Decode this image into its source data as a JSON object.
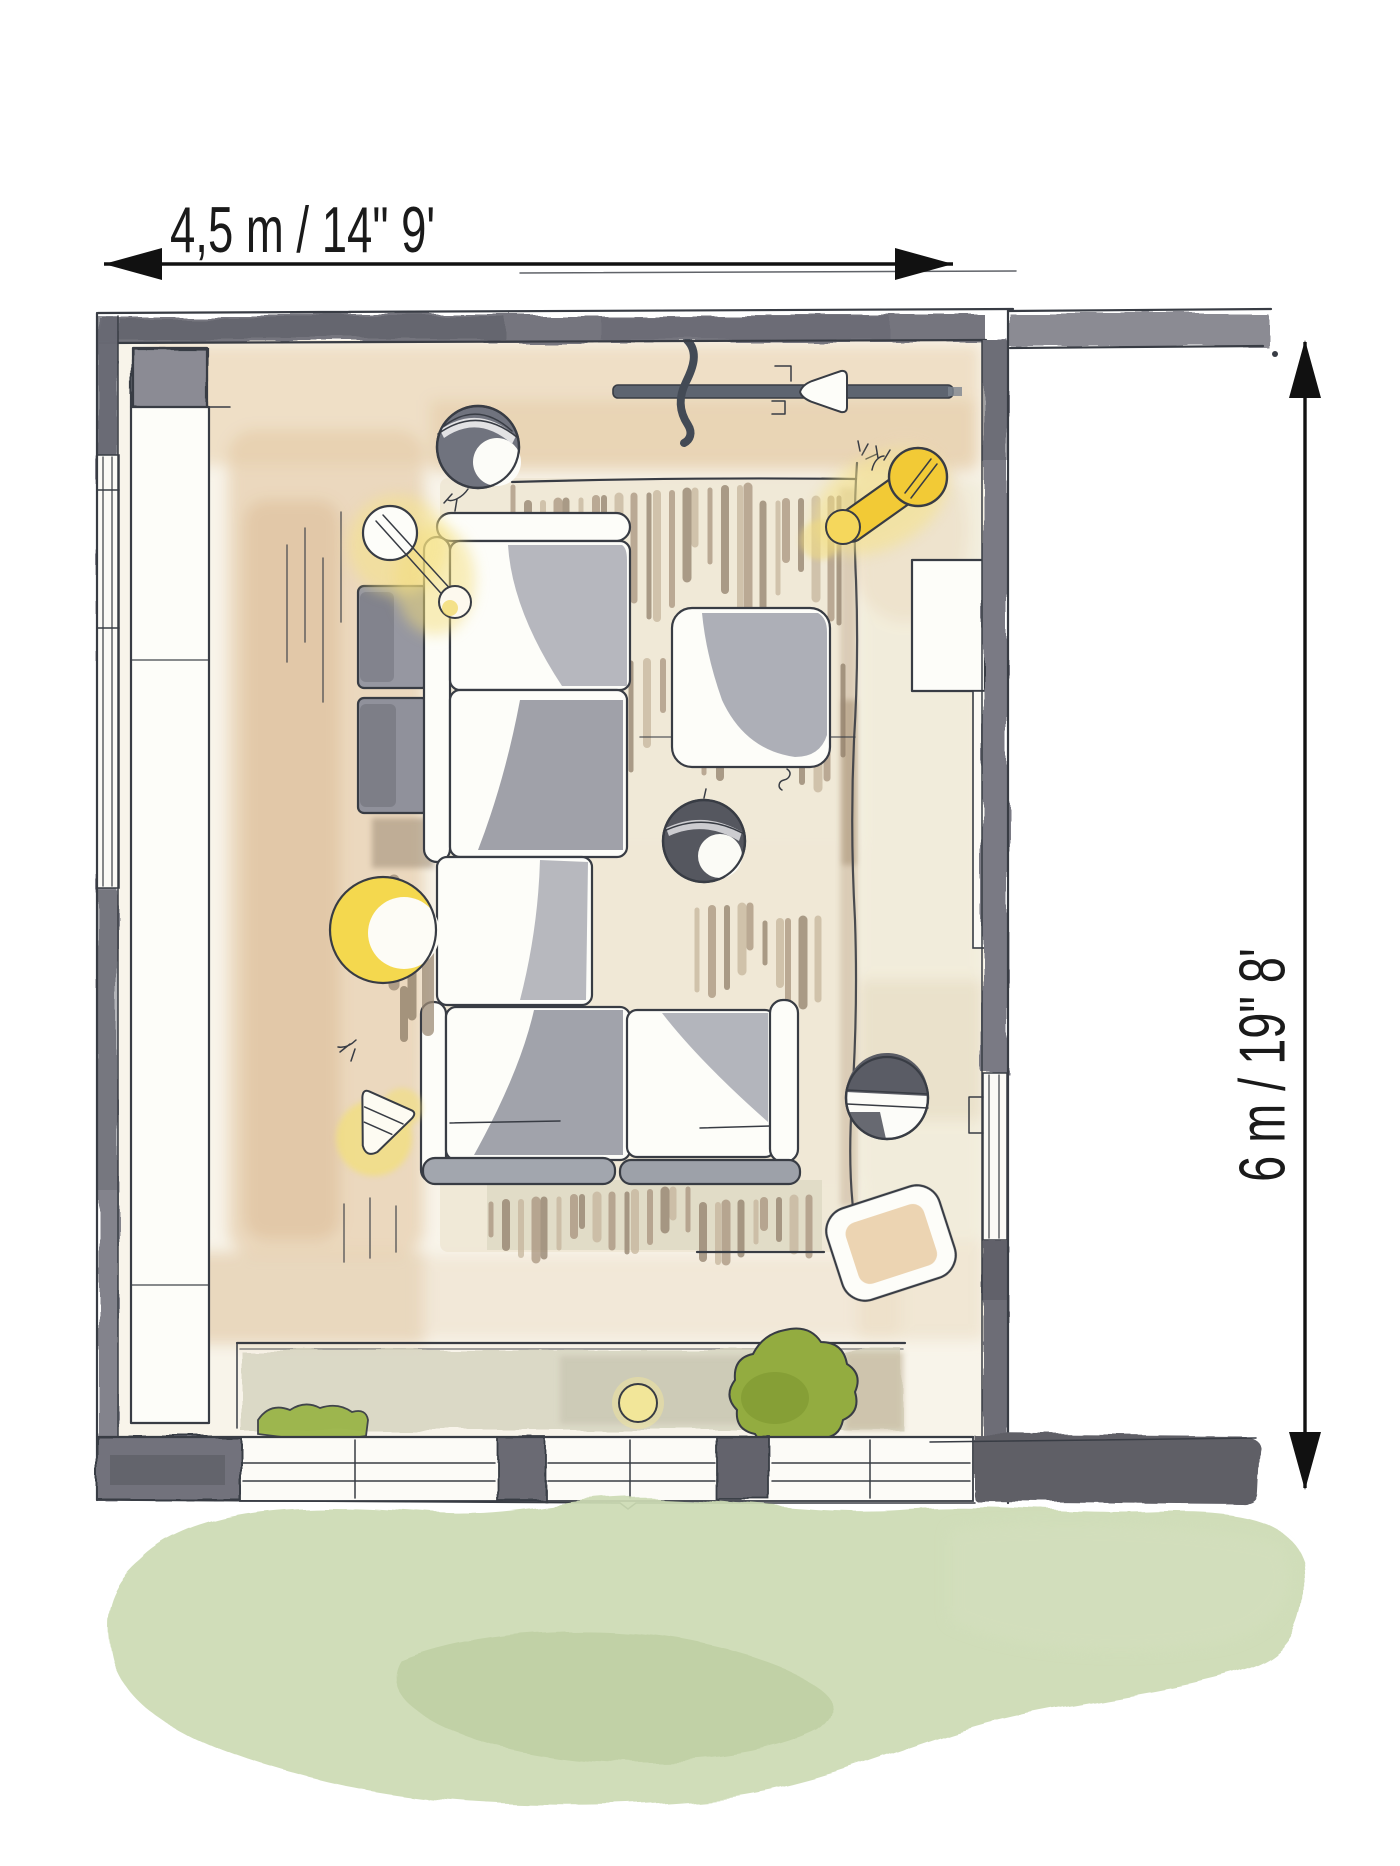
{
  "page": {
    "title": "Living room floor plan — watercolor sketch",
    "canvas": {
      "width_px": 1400,
      "height_px": 1866
    }
  },
  "annotations": {
    "width_dimension": {
      "label": "4,5 m  /  14\" 9'"
    },
    "depth_dimension": {
      "label": "6 m  /  19\" 8'"
    }
  },
  "palette": {
    "ink_outline": "#383c44",
    "wall_gray": "#75757e",
    "wall_dark": "#5e5e66",
    "accent_yellow": "#f2ca36",
    "glow_yellow": "#f6e388",
    "rug_fringe_tan": "#a5907a",
    "floor_cream": "#f8f4ea",
    "peach_wash": "#ecd9bd",
    "grass_green": "#ccdbb3",
    "bush_green": "#93ac40"
  },
  "plan": {
    "room": {
      "width_label": "4,5 m  /  14\" 9'",
      "depth_label": "6 m  /  19\" 8'"
    },
    "furniture": [
      "corner sectional sofa",
      "area rug",
      "coffee table",
      "pouf ottoman",
      "side console",
      "radiator",
      "left wall cabinet",
      "pendant sphere lamp x3",
      "yellow ball floor lamp",
      "yellow cone table lamp",
      "yellow wall lamp",
      "yellow table lamp",
      "wall light rail",
      "terrace planter with bushes",
      "lawn"
    ]
  }
}
